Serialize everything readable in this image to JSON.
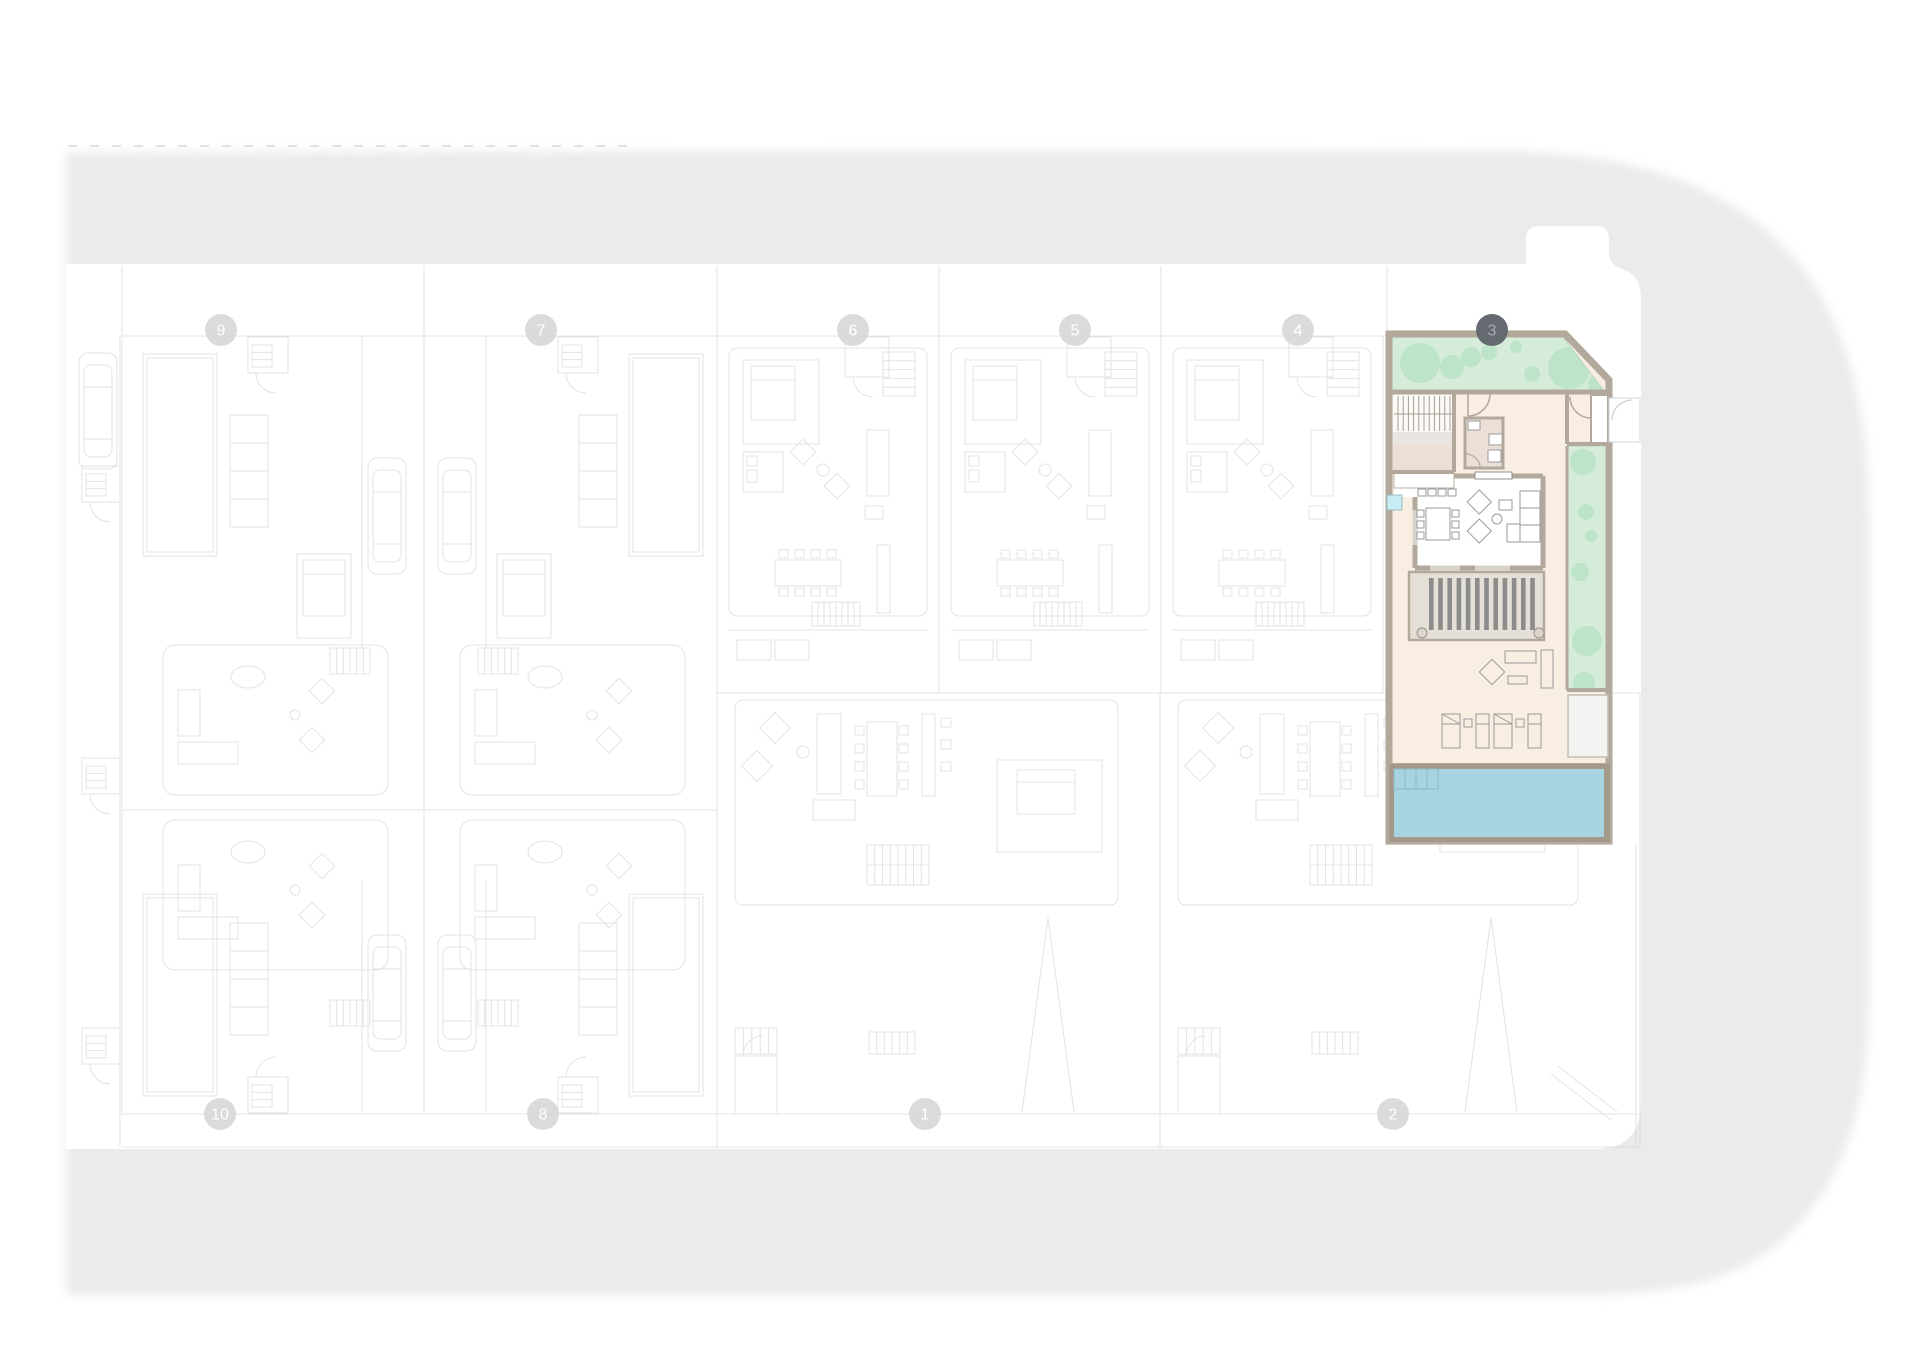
{
  "meta": {
    "view": "residential-site-plan",
    "floor": "ground-floor"
  },
  "street": {
    "color": "#eaebeb",
    "dashed_boundary": true
  },
  "markers": {
    "highlighted_plot": "3",
    "light_fill": "#d7d7d7",
    "light_text": "#ffffff",
    "dark_fill": "#646a6f",
    "dark_text": "#a6acb0",
    "items": [
      {
        "label": "9",
        "x": 221,
        "y": 330,
        "style": "light"
      },
      {
        "label": "7",
        "x": 541,
        "y": 330,
        "style": "light"
      },
      {
        "label": "6",
        "x": 853,
        "y": 330,
        "style": "light"
      },
      {
        "label": "5",
        "x": 1075,
        "y": 330,
        "style": "light"
      },
      {
        "label": "4",
        "x": 1298,
        "y": 330,
        "style": "light"
      },
      {
        "label": "3",
        "x": 1492,
        "y": 330,
        "style": "dark"
      },
      {
        "label": "10",
        "x": 220,
        "y": 1114,
        "style": "light"
      },
      {
        "label": "8",
        "x": 543,
        "y": 1114,
        "style": "light"
      },
      {
        "label": "1",
        "x": 925,
        "y": 1114,
        "style": "light"
      },
      {
        "label": "2",
        "x": 1393,
        "y": 1114,
        "style": "light"
      }
    ]
  },
  "unit3": {
    "plot_number": "3",
    "highlighted": true,
    "colors": {
      "wall": "#b2a89b",
      "wall_light": "#d8d3ca",
      "garden": "#d6ecda",
      "garden_edge": "#bcd7bd",
      "tree": "#a9ddbb",
      "floor_cream": "#f8efe2",
      "floor_pink": "#ecdfd8",
      "landing_grey": "#e9e6e1",
      "living_floor": "#ffffff",
      "pergola_deck": "#e4e0d8",
      "pergola_slat": "#8c8c8a",
      "pool_water": "#a8d4e2",
      "pool_line": "#8fb9c9",
      "deck_white": "#f3f3f1",
      "accent_cyan": "#c7ecf4",
      "furniture_line": "#9a9a98"
    },
    "features": [
      "front-garden",
      "staircase",
      "hallway",
      "bathroom",
      "storage-closet",
      "kitchen",
      "living-dining-room",
      "side-garden",
      "pergola-deck",
      "terrace",
      "outdoor-lounge",
      "sun-loungers",
      "swimming-pool",
      "pool-steps",
      "outdoor-shower"
    ],
    "trees_front": [
      [
        1420,
        363,
        20
      ],
      [
        1452,
        367,
        12
      ],
      [
        1471,
        357,
        10
      ],
      [
        1489,
        352,
        8
      ],
      [
        1516,
        347,
        6
      ],
      [
        1532,
        374,
        8
      ],
      [
        1569,
        368,
        21
      ],
      [
        1598,
        384,
        10
      ]
    ],
    "trees_side": [
      [
        1583,
        462,
        13
      ],
      [
        1586,
        512,
        8
      ],
      [
        1591,
        536,
        6
      ],
      [
        1580,
        572,
        9
      ],
      [
        1587,
        641,
        15
      ],
      [
        1584,
        683,
        11
      ]
    ],
    "pergola_slats": 12,
    "dining_chairs": 6,
    "sun_loungers": 4,
    "lounger_tables": 2
  },
  "background": {
    "line_color": "#c8cdd0",
    "faint_plots": [
      "9",
      "7",
      "6",
      "5",
      "4",
      "10",
      "8",
      "1",
      "2"
    ],
    "cars_on_plan": 5
  }
}
